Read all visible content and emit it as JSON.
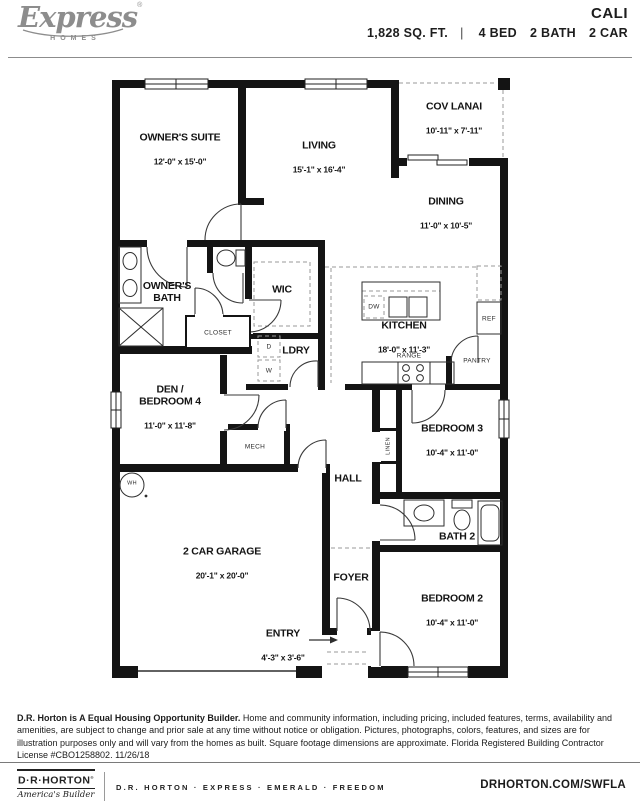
{
  "header": {
    "brand_script": "Express",
    "brand_reg": "®",
    "brand_sub": "HOMES",
    "plan_name": "CALI",
    "sqft": "1,828 SQ. FT.",
    "divider": "|",
    "bed": "4 BED",
    "bath": "2 BATH",
    "car": "2 CAR"
  },
  "plan": {
    "rooms": {
      "owners_suite": {
        "name": "OWNER'S SUITE",
        "dims": "12'-0\" x 15'-0\""
      },
      "living": {
        "name": "LIVING",
        "dims": "15'-1\" x 16'-4\""
      },
      "cov_lanai": {
        "name": "COV LANAI",
        "dims": "10'-11\" x 7'-11\""
      },
      "dining": {
        "name": "DINING",
        "dims": "11'-0\" x 10'-5\""
      },
      "owners_bath": {
        "name": "OWNER'S\nBATH"
      },
      "wic": {
        "name": "WIC"
      },
      "ldry": {
        "name": "LDRY"
      },
      "kitchen": {
        "name": "KITCHEN",
        "dims": "18'-0\" x 11'-3\""
      },
      "den_bedroom4": {
        "name": "DEN /\nBEDROOM 4",
        "dims": "11'-0\" x 11'-8\""
      },
      "hall": {
        "name": "HALL"
      },
      "bedroom3": {
        "name": "BEDROOM 3",
        "dims": "10'-4\" x 11'-0\""
      },
      "bath2": {
        "name": "BATH 2"
      },
      "bedroom2": {
        "name": "BEDROOM 2",
        "dims": "10'-4\" x 11'-0\""
      },
      "garage": {
        "name": "2 CAR GARAGE",
        "dims": "20'-1\" x 20'-0\""
      },
      "foyer": {
        "name": "FOYER"
      },
      "entry": {
        "name": "ENTRY",
        "dims": "4'-3\" x 3'-6\""
      }
    },
    "labels": {
      "closet": "CLOSET",
      "mech": "MECH",
      "wh": "WH",
      "linen": "LINEN",
      "dw": "DW",
      "ref": "REF",
      "range": "RANGE",
      "pantry": "PANTRY",
      "dryer": "D",
      "washer": "W"
    }
  },
  "footer": {
    "disclaimer_bold": "D.R. Horton is A Equal Housing Opportunity Builder.",
    "disclaimer_rest": " Home and community information, including pricing, included features, terms, availability and amenities, are subject to change and prior sale at any time without notice or obligation. Pictures, photographs, colors, features, and sizes are for illustration purposes only and will vary from the homes as built. Square footage dimensions are approximate.  Florida Registered Building Contractor License #CBO1258802.  11/26/18",
    "logo_name": "D·R·HORTON",
    "logo_reg": "®",
    "logo_tagline": "America's Builder",
    "brands": "D.R. HORTON · EXPRESS · EMERALD · FREEDOM",
    "website": "DRHORTON.COM/SWFLA"
  },
  "colors": {
    "wall": "#141414",
    "thin_line": "#2e2e2e",
    "dashed": "#9a9a9a",
    "brand_gray": "#8d8d8d"
  }
}
